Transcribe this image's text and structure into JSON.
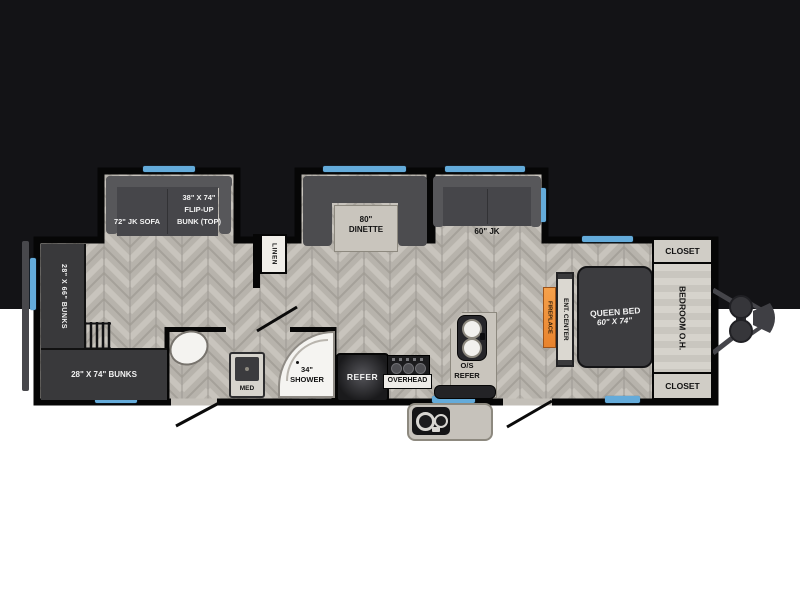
{
  "title": "328SB",
  "fp": {
    "slides": {
      "sofa": {
        "label": "72\" JK SOFA",
        "bunk1": "38\" X 74\"",
        "bunk2": "FLIP-UP",
        "bunk3": "BUNK (TOP)"
      },
      "dinette": {
        "size": "80\"",
        "name": "DINETTE"
      },
      "jk": {
        "label": "60\" JK"
      }
    },
    "linen": "LINEN",
    "bunks": {
      "side": "28\" X 66\" BUNKS",
      "rear": "28\" X 74\" BUNKS"
    },
    "bath": {
      "shower_size": "34\"",
      "shower": "SHOWER",
      "med": "MED"
    },
    "kitchen": {
      "refer": "REFER",
      "overhead": "OVERHEAD",
      "os1": "O/S",
      "os2": "REFER"
    },
    "bedroom": {
      "fireplace": "FIREPLACE",
      "ent": "ENT. CENTER",
      "bed1": "QUEEN BED",
      "bed2": "60\" X 74\"",
      "oh": "BEDROOM O.H.",
      "closet_top": "CLOSET",
      "closet_bottom": "CLOSET"
    },
    "colors": {
      "band_bg": "#131316",
      "wall": "#060606",
      "floor": "#b7b3ac",
      "window": "#64abda",
      "fireplace_accent": "#ef9140",
      "furniture_dark": "#3c3c3f",
      "counter": "#c9c5bd"
    }
  }
}
